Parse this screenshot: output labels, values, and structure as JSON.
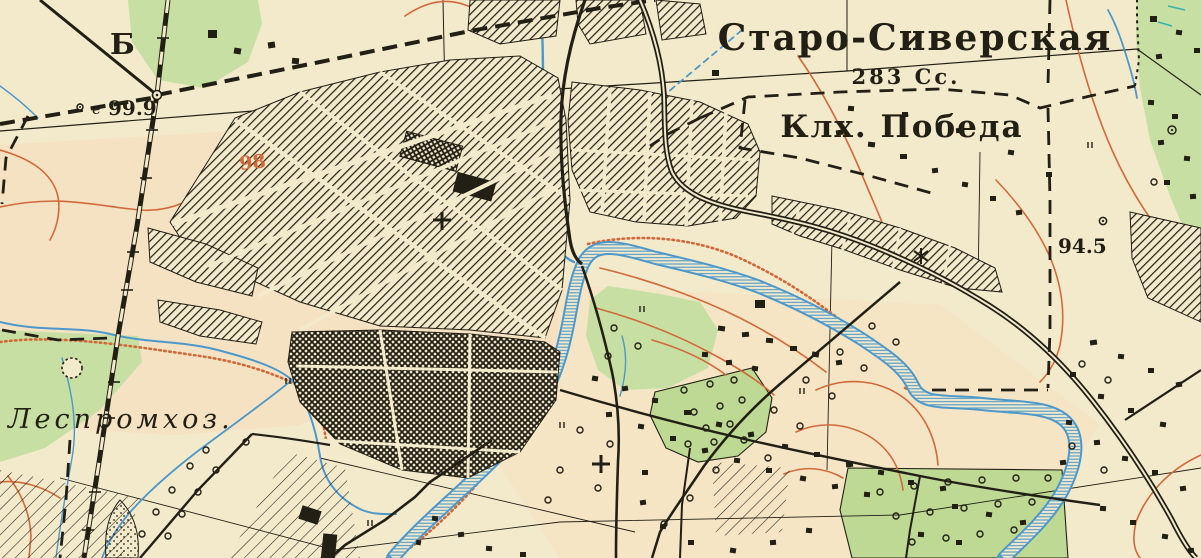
{
  "meta": {
    "type": "historical topographic map",
    "language": "ru"
  },
  "labels": {
    "settlement_name": "Старо-Сиверская",
    "settlement_info": "283 Сс.",
    "kolkhoz_name": "Клх. Победа",
    "lespromkhoz": "Леспромхоз.",
    "corner_letter": "Б",
    "spot_height_prefix": "е",
    "spot_height_1": "99.9",
    "spot_height_2": "94.5",
    "contour_label": "98"
  },
  "colors": {
    "paper": "#f3e9cb",
    "paper_tint": "#f8dcba",
    "forest_green": "#c7dfa2",
    "orchard_green": "#bdd994",
    "water_blue": "#4d98ca",
    "water_fill": "#d8ebf6",
    "contour_orange": "#d2693b",
    "ink_black": "#221f15"
  }
}
